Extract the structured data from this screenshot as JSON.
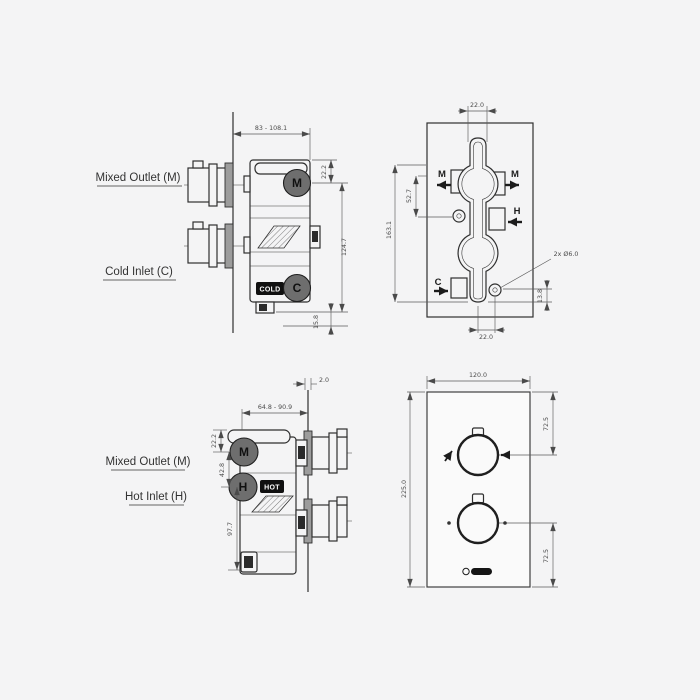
{
  "meta": {
    "title": "Thermostatic shower valve technical drawing",
    "background": "#f4f4f5",
    "line_color": "#2f2f2f",
    "dim_color": "#4a4a4a",
    "port_circle_fill": "#6e6e6e",
    "tag_background": "#101010"
  },
  "views": {
    "side_cold": {
      "labels": {
        "mixed_outlet": "Mixed Outlet (M)",
        "cold_inlet": "Cold Inlet (C)"
      },
      "ports": {
        "mixed": "M",
        "cold": "C",
        "cold_tag": "COLD"
      },
      "dims": {
        "depth_range": "83 - 108.1",
        "top_offset": "22.2",
        "port_spacing": "124.7",
        "bottom_offset": "15.8"
      }
    },
    "plan": {
      "ports": {
        "mixed_left": "M",
        "mixed_right": "M",
        "hot": "H",
        "cold": "C"
      },
      "dims": {
        "stem_width_top": "22.0",
        "upper_spacing": "52.7",
        "overall_height": "163.1",
        "fixing_holes": "2x Ø6.0",
        "hole_offset": "13.8",
        "stem_width_bottom": "22.0"
      }
    },
    "side_hot": {
      "labels": {
        "mixed_outlet": "Mixed Outlet (M)",
        "hot_inlet": "Hot Inlet (H)"
      },
      "ports": {
        "mixed": "M",
        "hot": "H",
        "hot_tag": "HOT"
      },
      "dims": {
        "wall_thickness": "2.0",
        "depth_range": "64.8 - 90.9",
        "top_offset": "22.2",
        "port_spacing": "42.8",
        "lower_spacing": "97.7"
      }
    },
    "faceplate": {
      "dims": {
        "width": "120.0",
        "height": "225.0",
        "top_knob_offset": "72.5",
        "bottom_knob_offset": "72.5"
      },
      "brand": {
        "icon": "brand-logo"
      }
    }
  }
}
